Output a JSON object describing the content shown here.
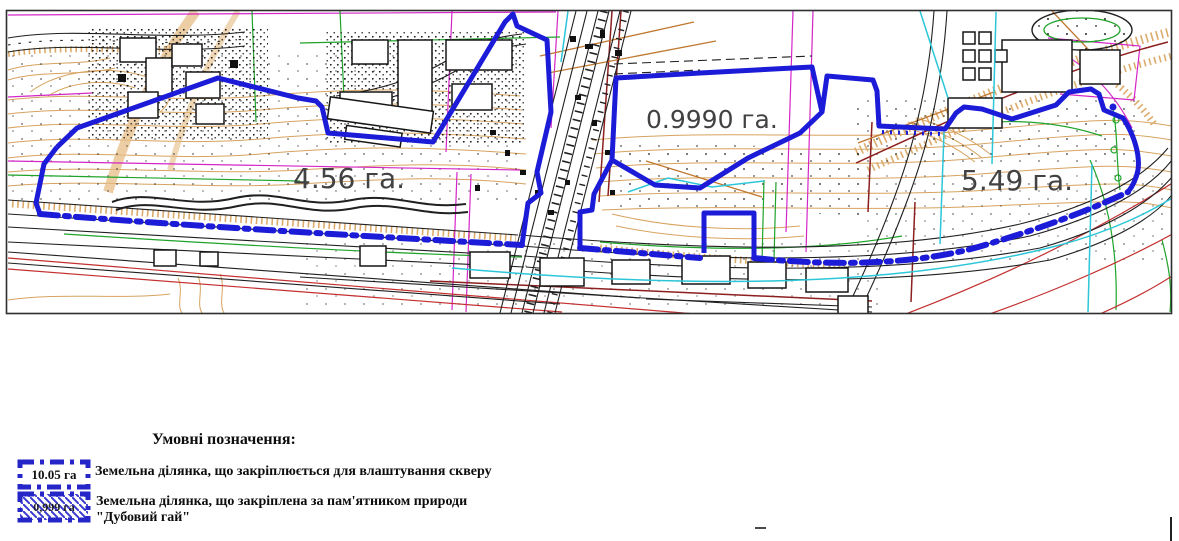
{
  "map": {
    "plots": [
      {
        "id": "sker-west",
        "area_label": "4.56 га."
      },
      {
        "id": "dubovyi-hai",
        "area_label": "0.9990 га."
      },
      {
        "id": "sker-east",
        "area_label": "5.49 га."
      }
    ],
    "boundary_style": "blue dash-dot polygon",
    "hatched_plot": "dubovyi-hai"
  },
  "legend": {
    "title": "Умовні позначення:",
    "items": [
      {
        "symbol": "blue-dashdot-rect",
        "symbol_text": "10.05 га",
        "lines": [
          "Земельна ділянка, що закріплюється для влаштування скверу"
        ]
      },
      {
        "symbol": "blue-dashdot-rect-hatched",
        "symbol_text": "0,999 га",
        "lines": [
          "Земельна ділянка, що закріплена за пам'ятником природи",
          "\"Дубовий гай\""
        ]
      }
    ]
  },
  "colors": {
    "boundary_blue": "#1b1bd8",
    "hatch_blue": "#4343d2",
    "legend_blue": "#2525c8",
    "contour_tan": "#d7a35f",
    "label_gray": "#424242",
    "magenta": "#d426c8",
    "green": "#1fa32a",
    "cyan": "#2cc6d8",
    "red": "#c43030",
    "dark_red": "#8c1f1f",
    "line_black": "#202020"
  }
}
